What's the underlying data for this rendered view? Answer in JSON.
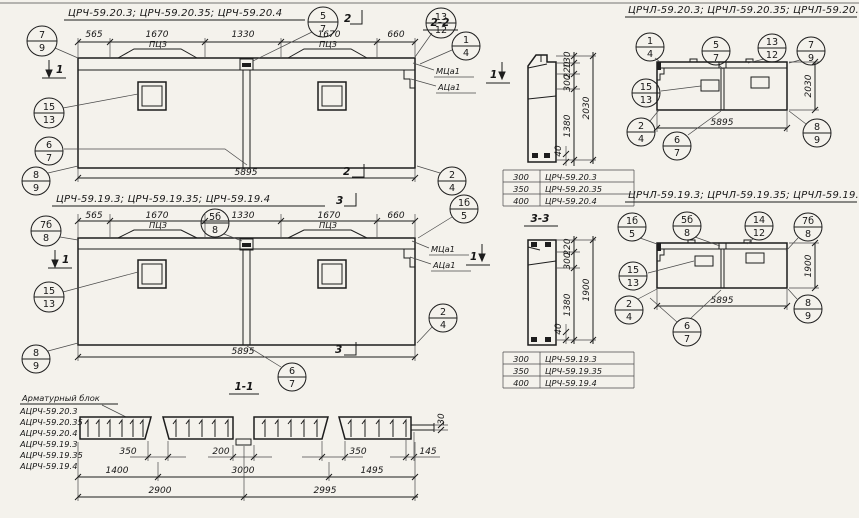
{
  "row1": {
    "title": "ЦРЧ-59.20.3;  ЦРЧ-59.20.35;  ЦРЧ-59.20.4",
    "dims_top": [
      "565",
      "1670",
      "1330",
      "1670",
      "660"
    ],
    "dim_bottom": "5895",
    "loop_label": "ПЦЗ",
    "anchor_top": "МЦа1",
    "anchor_bottom": "АЦа1",
    "section_marker": "2",
    "side_marker": "1"
  },
  "row2": {
    "title": "ЦРЧ-59.19.3;  ЦРЧ-59.19.35;  ЦРЧ-59.19.4",
    "dims_top": [
      "565",
      "1670",
      "1330",
      "1670",
      "660"
    ],
    "dim_bottom": "5895",
    "loop_label": "ПЦЗ",
    "anchor_top": "МЦа1",
    "anchor_bottom": "АЦа1",
    "section_marker": "3",
    "side_marker": "1"
  },
  "sec22": {
    "label": "2-2",
    "dims": [
      "130",
      "220",
      "300",
      "1380"
    ],
    "total": "2030",
    "rib": "40",
    "table": [
      [
        "300",
        "ЦРЧ-59.20.3"
      ],
      [
        "350",
        "ЦРЧ-59.20.35"
      ],
      [
        "400",
        "ЦРЧ-59.20.4"
      ]
    ]
  },
  "sec33": {
    "label": "3-3",
    "dims": [
      "220",
      "300",
      "1380"
    ],
    "total": "1900",
    "rib": "40",
    "table": [
      [
        "300",
        "ЦРЧ-59.19.3"
      ],
      [
        "350",
        "ЦРЧ-59.19.35"
      ],
      [
        "400",
        "ЦРЧ-59.19.4"
      ]
    ]
  },
  "elev1": {
    "title": "ЦРЧЛ-59.20.3;  ЦРЧЛ-59.20.35;  ЦРЧЛ-59.20.4",
    "width": "5895",
    "height": "2030"
  },
  "elev2": {
    "title": "ЦРЧЛ-59.19.3;  ЦРЧЛ-59.19.35;  ЦРЧЛ-59.19.4",
    "width": "5895",
    "height": "1900"
  },
  "sec11": {
    "label": "1-1",
    "block_title": "Арматурный блок",
    "blocks": [
      "АЦРЧ-59.20.3",
      "АЦРЧ-59.20.35",
      "АЦРЧ-59.20.4",
      "АЦРЧ-59.19.3",
      "АЦРЧ-59.19.35",
      "АЦРЧ-59.19.4"
    ],
    "gaps": [
      "350",
      "200",
      "350",
      "145"
    ],
    "spans": [
      "1400",
      "3000",
      "1495"
    ],
    "totals": [
      "2900",
      "2995"
    ],
    "thickness": "30"
  },
  "callouts": {
    "r1a": {
      "t": "7",
      "b": "9"
    },
    "r1b": {
      "t": "5",
      "b": "7"
    },
    "r1c": {
      "t": "13",
      "b": "12"
    },
    "r1d": {
      "t": "1",
      "b": "4"
    },
    "r1e": {
      "t": "15",
      "b": "13"
    },
    "r1f": {
      "t": "6",
      "b": "7"
    },
    "r1g": {
      "t": "8",
      "b": "9"
    },
    "r1h": {
      "t": "2",
      "b": "4"
    },
    "r2a": {
      "t": "7б",
      "b": "8"
    },
    "r2b": {
      "t": "5б",
      "b": "8"
    },
    "r2c": {
      "t": "1б",
      "b": "5"
    },
    "r2d": {
      "t": "15",
      "b": "13"
    },
    "r2e": {
      "t": "8",
      "b": "9"
    },
    "r2f": {
      "t": "6",
      "b": "7"
    },
    "r2g": {
      "t": "2",
      "b": "4"
    },
    "e1a": {
      "t": "1",
      "b": "4"
    },
    "e1b": {
      "t": "5",
      "b": "7"
    },
    "e1c": {
      "t": "13",
      "b": "12"
    },
    "e1d": {
      "t": "7",
      "b": "9"
    },
    "e1e": {
      "t": "15",
      "b": "13"
    },
    "e1f": {
      "t": "2",
      "b": "4"
    },
    "e1g": {
      "t": "8",
      "b": "9"
    },
    "e1h": {
      "t": "6",
      "b": "7"
    },
    "e2a": {
      "t": "1б",
      "b": "5"
    },
    "e2b": {
      "t": "5б",
      "b": "8"
    },
    "e2c": {
      "t": "14",
      "b": "12"
    },
    "e2d": {
      "t": "7б",
      "b": "8"
    },
    "e2e": {
      "t": "15",
      "b": "13"
    },
    "e2f": {
      "t": "2",
      "b": "4"
    },
    "e2g": {
      "t": "8",
      "b": "9"
    },
    "e2h": {
      "t": "6",
      "b": "7"
    }
  }
}
